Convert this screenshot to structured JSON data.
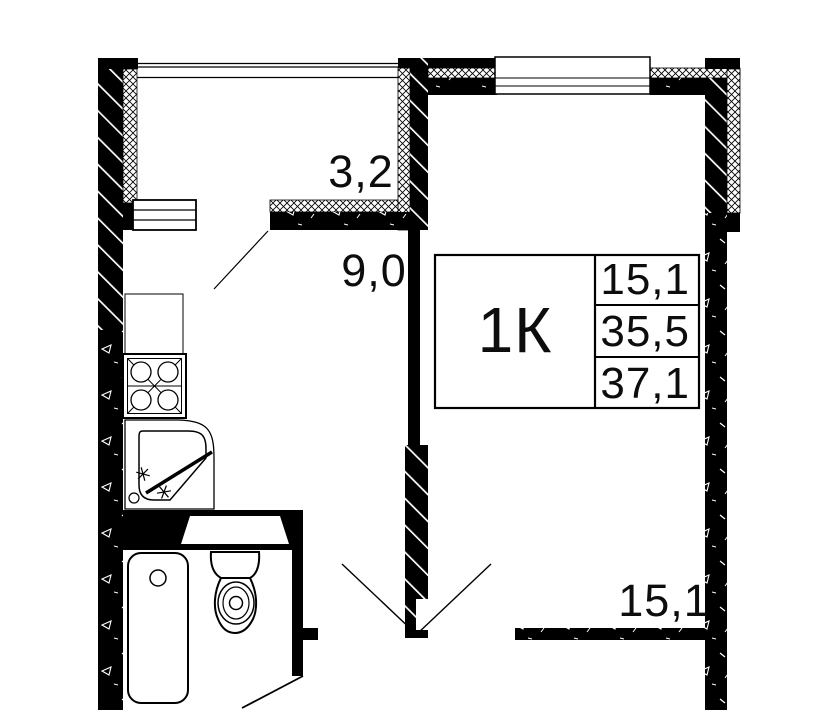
{
  "meta": {
    "title": "1-room apartment floor plan"
  },
  "unit": {
    "type_label": "1К",
    "area_rows": [
      {
        "value": "15,1"
      },
      {
        "value": "35,5"
      },
      {
        "value": "37,1"
      }
    ]
  },
  "rooms": [
    {
      "id": "balcony",
      "area_label": "3,2"
    },
    {
      "id": "kitchen",
      "area_label": "9,0"
    },
    {
      "id": "living-room",
      "area_label": "15,1"
    }
  ],
  "colors": {
    "walls": "#000000",
    "background": "#ffffff"
  }
}
